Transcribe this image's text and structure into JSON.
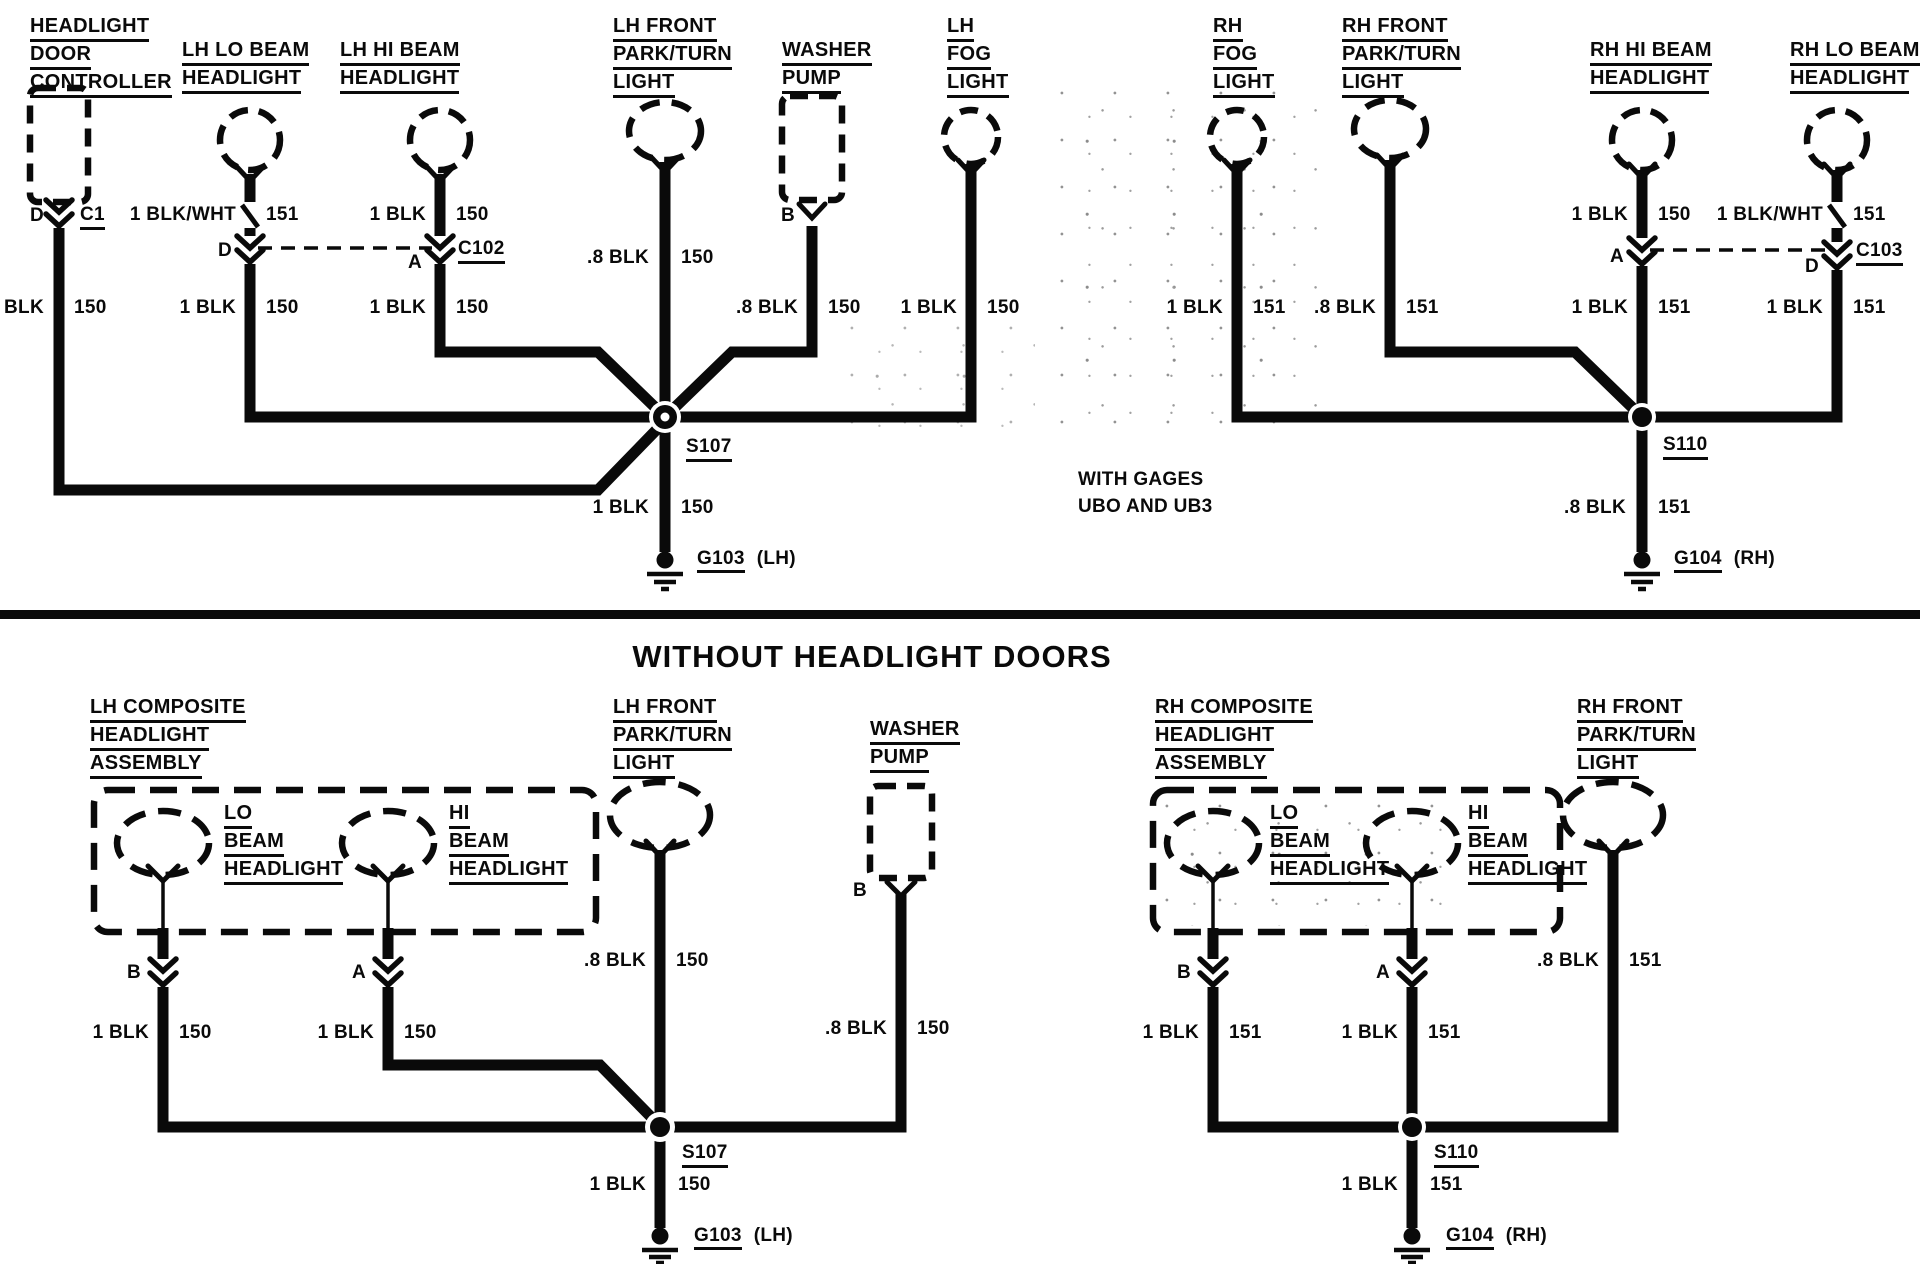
{
  "shared": {
    "s107": "S107",
    "s110": "S110",
    "g103": "G103",
    "g104": "G104",
    "lh_suffix": "(LH)",
    "rh_suffix": "(RH)",
    "pin_a": "A",
    "pin_b": "B",
    "pin_d": "D"
  },
  "top": {
    "controller": {
      "lines": [
        "HEADLIGHT",
        "DOOR",
        "CONTROLLER"
      ],
      "pin": "D",
      "connector": "C1",
      "w2l": "1 BLK",
      "w2r": "150"
    },
    "lh_lo": {
      "lines": [
        "LH LO BEAM",
        "HEADLIGHT"
      ],
      "w1l": "1 BLK/WHT",
      "w1r": "151",
      "pin": "D",
      "w2l": "1 BLK",
      "w2r": "150"
    },
    "lh_hi": {
      "lines": [
        "LH HI BEAM",
        "HEADLIGHT"
      ],
      "w1l": "1 BLK",
      "w1r": "150",
      "pin": "A",
      "connector": "C102",
      "w2l": "1 BLK",
      "w2r": "150"
    },
    "lh_park": {
      "lines": [
        "LH FRONT",
        "PARK/TURN",
        "LIGHT"
      ],
      "w1l": ".8 BLK",
      "w1r": "150"
    },
    "washer": {
      "lines": [
        "WASHER",
        "PUMP"
      ],
      "pin": "B",
      "w1l": ".8 BLK",
      "w1r": "150"
    },
    "lh_fog": {
      "lines": [
        "LH",
        "FOG",
        "LIGHT"
      ],
      "w1l": "1 BLK",
      "w1r": "150"
    },
    "rh_fog": {
      "lines": [
        "RH",
        "FOG",
        "LIGHT"
      ],
      "w1l": "1 BLK",
      "w1r": "151"
    },
    "rh_park": {
      "lines": [
        "RH FRONT",
        "PARK/TURN",
        "LIGHT"
      ],
      "w1l": ".8 BLK",
      "w1r": "151"
    },
    "rh_hi": {
      "lines": [
        "RH HI BEAM",
        "HEADLIGHT"
      ],
      "w1l": "1 BLK",
      "w1r": "150",
      "pin": "A",
      "w2l": "1 BLK",
      "w2r": "151"
    },
    "rh_lo": {
      "lines": [
        "RH LO BEAM",
        "HEADLIGHT"
      ],
      "w1l": "1 BLK/WHT",
      "w1r": "151",
      "pin": "D",
      "connector": "C103",
      "w2l": "1 BLK",
      "w2r": "151"
    },
    "s107_wire": {
      "l": "1 BLK",
      "r": "150"
    },
    "s110_wire": {
      "l": ".8 BLK",
      "r": "151"
    },
    "note": [
      "WITH GAGES",
      "UBO AND UB3"
    ]
  },
  "section_title": "WITHOUT HEADLIGHT DOORS",
  "bottom": {
    "lh_assembly": [
      "LH COMPOSITE",
      "HEADLIGHT",
      "ASSEMBLY"
    ],
    "rh_assembly": [
      "RH COMPOSITE",
      "HEADLIGHT",
      "ASSEMBLY"
    ],
    "lo_label": [
      "LO",
      "BEAM",
      "HEADLIGHT"
    ],
    "hi_label": [
      "HI",
      "BEAM",
      "HEADLIGHT"
    ],
    "lh_park": [
      "LH FRONT",
      "PARK/TURN",
      "LIGHT"
    ],
    "rh_park": [
      "RH FRONT",
      "PARK/TURN",
      "LIGHT"
    ],
    "washer": [
      "WASHER",
      "PUMP"
    ],
    "lh_lo_w": {
      "l": "1 BLK",
      "r": "150"
    },
    "lh_hi_w": {
      "l": "1 BLK",
      "r": "150"
    },
    "lh_park_w": {
      "l": ".8 BLK",
      "r": "150"
    },
    "washer_w": {
      "l": ".8 BLK",
      "r": "150"
    },
    "lh_gnd_w": {
      "l": "1 BLK",
      "r": "150"
    },
    "rh_lo_w": {
      "l": "1 BLK",
      "r": "151"
    },
    "rh_hi_w": {
      "l": "1 BLK",
      "r": "151"
    },
    "rh_park_w": {
      "l": ".8 BLK",
      "r": "151"
    },
    "rh_gnd_w": {
      "l": "1 BLK",
      "r": "151"
    }
  }
}
